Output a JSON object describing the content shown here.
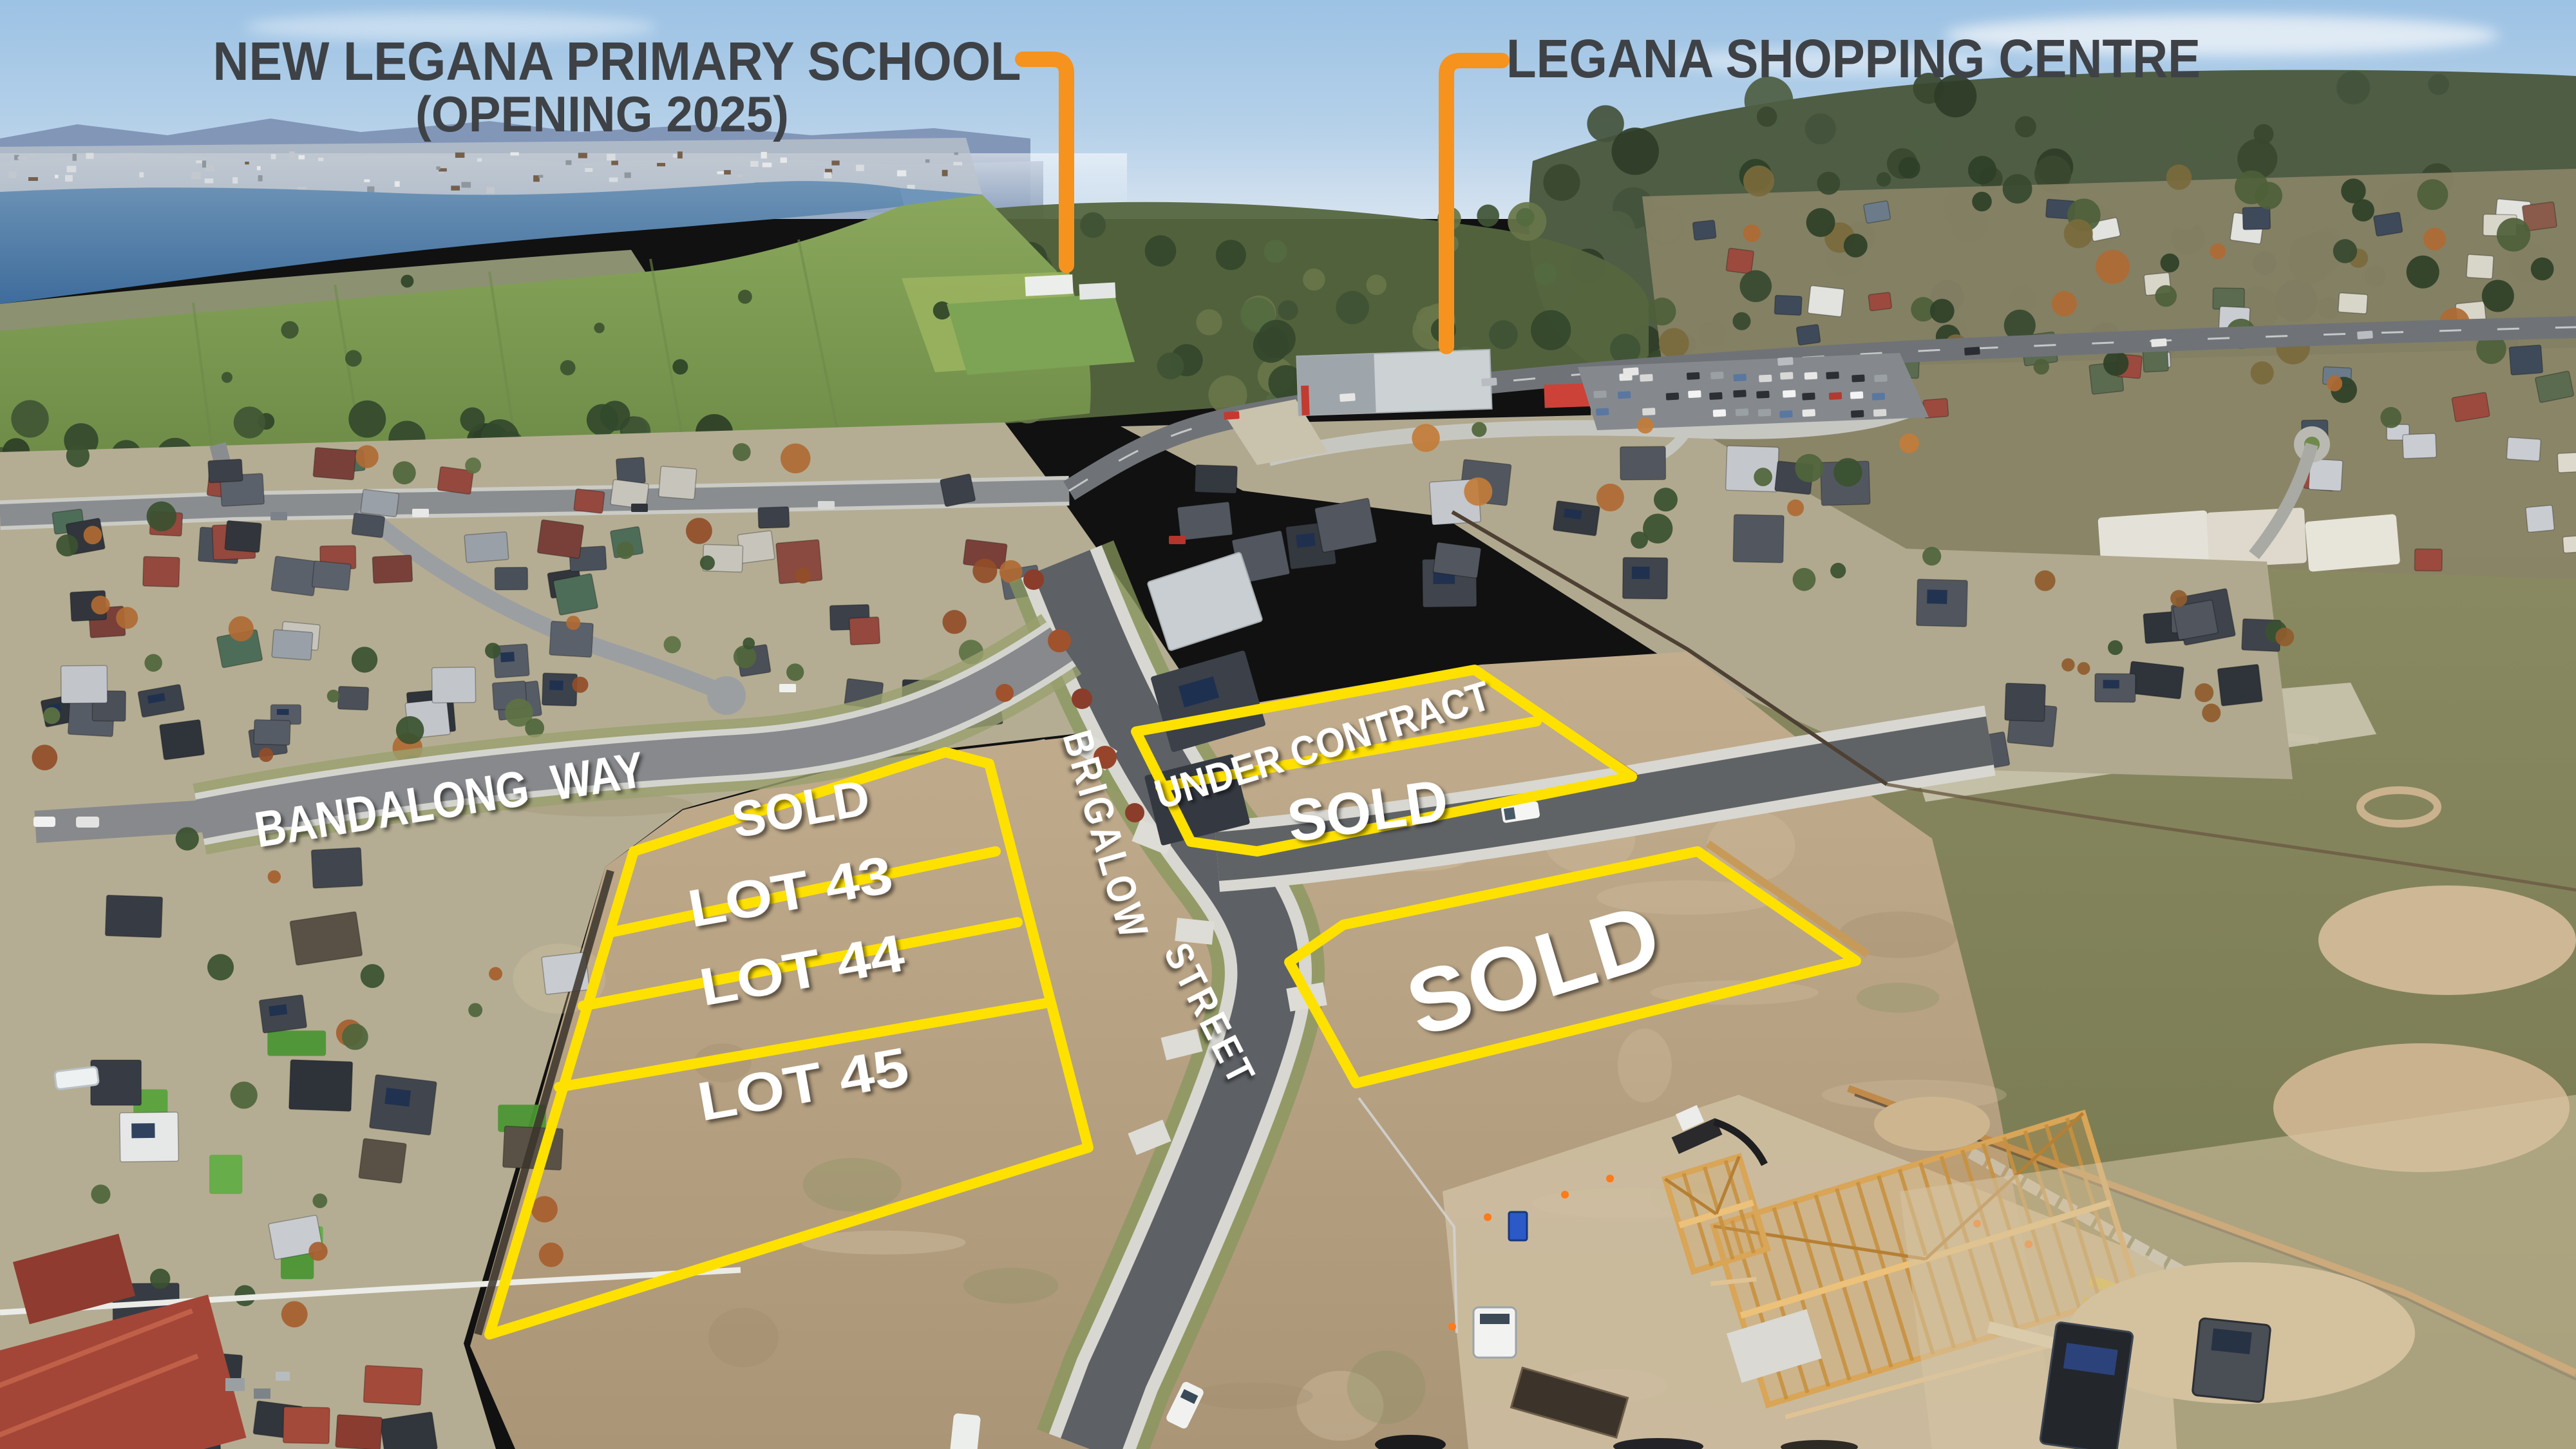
{
  "annotations": {
    "school": {
      "line1": "NEW LEGANA PRIMARY SCHOOL",
      "line2": "(OPENING 2025)"
    },
    "shopping_centre": {
      "label": "LEGANA SHOPPING CENTRE"
    }
  },
  "streets": {
    "bandalong": "BANDALONG  WAY",
    "brigalow": {
      "word1": "BRIGALOW",
      "word2": "STREET"
    }
  },
  "lots": {
    "left_group": [
      {
        "label": "SOLD"
      },
      {
        "label": "LOT 43"
      },
      {
        "label": "LOT 44"
      },
      {
        "label": "LOT 45"
      }
    ],
    "corner_group": [
      {
        "label": "UNDER CONTRACT"
      },
      {
        "label": "SOLD"
      }
    ],
    "large_lot": {
      "label": "SOLD"
    }
  },
  "colors": {
    "lot_outline": "#FFE100",
    "pointer_orange": "#F6921E",
    "title_text": "#3E4246",
    "lot_text": "#FFFFFF"
  }
}
